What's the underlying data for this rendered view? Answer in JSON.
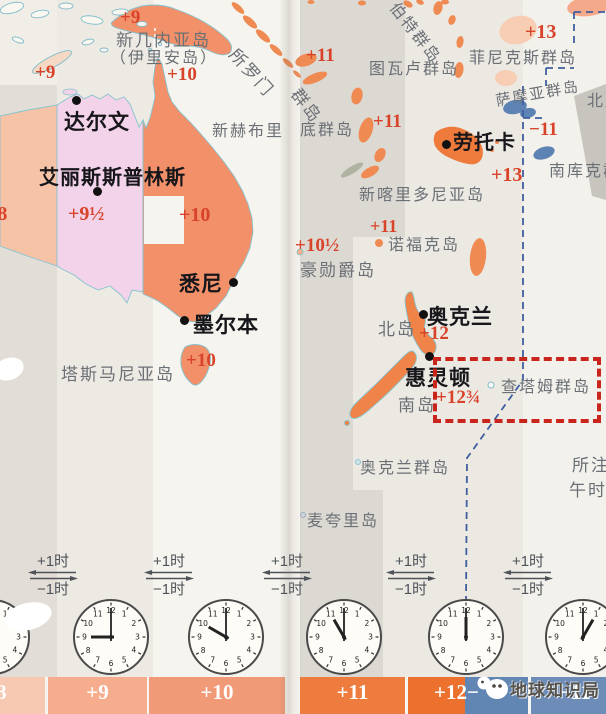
{
  "document": {
    "description": "扫描书页：大洋洲时区地图（澳大利亚/新西兰/太平洋岛屿）",
    "watermark_text": "地球知识局",
    "watermark_icon": "penguin-logo"
  },
  "colors": {
    "orange_land": "#f2906a",
    "strong_orange": "#ee7b3c",
    "pink_zone": "#f3d3e9",
    "salmon_zone": "#f7c3a6",
    "pale_island": "#f7cdb4",
    "blue_island": "#5d83b4",
    "red_label": "#d8432a",
    "gray_label": "#6b7076",
    "date_line_blue": "#3f5fa0",
    "annotation_red": "#c9251c",
    "bar_blue": "#6d8cb7"
  },
  "map_labels": [
    {
      "name": "tz-plus9-top",
      "text": "+9",
      "x": 120,
      "y": 7,
      "cls": "lbl-zone",
      "size": 19
    },
    {
      "name": "tz-plus9-west",
      "text": "+9",
      "x": 35,
      "y": 62,
      "cls": "lbl-zone",
      "size": 19
    },
    {
      "name": "tz-plus10-north",
      "text": "+10",
      "x": 167,
      "y": 64,
      "cls": "lbl-zone",
      "size": 19
    },
    {
      "name": "tz-plus8-west",
      "text": "+8",
      "x": -14,
      "y": 203,
      "cls": "lbl-zone",
      "size": 20
    },
    {
      "name": "tz-plus9half",
      "text": "+9½",
      "x": 68,
      "y": 203,
      "cls": "lbl-zone",
      "size": 20
    },
    {
      "name": "tz-plus10-mid",
      "text": "+10",
      "x": 179,
      "y": 204,
      "cls": "lbl-zone",
      "size": 20
    },
    {
      "name": "tz-plus10-tasmania",
      "text": "+10",
      "x": 186,
      "y": 350,
      "cls": "lbl-zone",
      "size": 19
    },
    {
      "name": "tz-plus11-santacruz",
      "text": "+11",
      "x": 306,
      "y": 45,
      "cls": "lbl-zone",
      "size": 19
    },
    {
      "name": "tz-plus11-vanuatu",
      "text": "+11",
      "x": 373,
      "y": 111,
      "cls": "lbl-zone",
      "size": 19
    },
    {
      "name": "tz-plus11-norfolk",
      "text": "+11",
      "x": 370,
      "y": 216,
      "cls": "lbl-zone",
      "size": 18
    },
    {
      "name": "tz-plus10half",
      "text": "+10½",
      "x": 295,
      "y": 235,
      "cls": "lbl-zone",
      "size": 19
    },
    {
      "name": "tz-plus12-nz",
      "text": "+12",
      "x": 419,
      "y": 323,
      "cls": "lbl-zone",
      "size": 19
    },
    {
      "name": "tz-plus12-threequarters",
      "text": "+12¾",
      "x": 436,
      "y": 387,
      "cls": "lbl-zone",
      "size": 19
    },
    {
      "name": "tz-plus13-phoenix",
      "text": "+13",
      "x": 525,
      "y": 21,
      "cls": "lbl-zone",
      "size": 20
    },
    {
      "name": "tz-plus13-fiji-east",
      "text": "+13",
      "x": 491,
      "y": 164,
      "cls": "lbl-zone",
      "size": 20
    },
    {
      "name": "tz-minus11",
      "text": "−11",
      "x": 529,
      "y": 119,
      "cls": "lbl-zone",
      "size": 19
    },
    {
      "name": "label-new-guinea-line1",
      "text": "新几内亚岛",
      "x": 116,
      "y": 26,
      "cls": "lbl-geo",
      "size": 17
    },
    {
      "name": "label-new-guinea-line2",
      "text": "（伊里安岛）",
      "x": 110,
      "y": 44,
      "cls": "lbl-geo",
      "size": 16
    },
    {
      "name": "label-solomon-part1",
      "text": "所罗门",
      "x": 243,
      "y": 42,
      "cls": "lbl-geo",
      "size": 17,
      "rot": 48
    },
    {
      "name": "label-solomon-part2",
      "text": "群岛",
      "x": 306,
      "y": 82,
      "cls": "lbl-geo",
      "size": 17,
      "rot": 52
    },
    {
      "name": "label-new-hebrides-part1",
      "text": "新赫布里",
      "x": 212,
      "y": 117,
      "cls": "lbl-geo",
      "size": 16
    },
    {
      "name": "label-new-hebrides-part2",
      "text": "底群岛",
      "x": 300,
      "y": 116,
      "cls": "lbl-geo",
      "size": 16
    },
    {
      "name": "label-tuvalu",
      "text": "图瓦卢群岛",
      "x": 369,
      "y": 55,
      "cls": "lbl-geo",
      "size": 16
    },
    {
      "name": "label-gilbert-partial",
      "text": "伯特群岛",
      "x": 404,
      "y": -4,
      "cls": "lbl-geo",
      "size": 16,
      "rot": 52
    },
    {
      "name": "label-phoenix-islands",
      "text": "菲尼克斯群岛",
      "x": 469,
      "y": 44,
      "cls": "lbl-geo",
      "size": 16
    },
    {
      "name": "label-samoa",
      "text": "萨摩亚群岛",
      "x": 494,
      "y": 90,
      "cls": "lbl-geo",
      "size": 15,
      "rot": -10
    },
    {
      "name": "label-north-cook-partial",
      "text": "北库克群岛",
      "x": 587,
      "y": 87,
      "cls": "lbl-geo",
      "size": 16
    },
    {
      "name": "label-south-cook-partial",
      "text": "南库克群岛",
      "x": 549,
      "y": 157,
      "cls": "lbl-geo",
      "size": 16
    },
    {
      "name": "label-new-caledonia",
      "text": "新喀里多尼亚岛",
      "x": 359,
      "y": 181,
      "cls": "lbl-geo",
      "size": 16
    },
    {
      "name": "label-norfolk-island",
      "text": "诺福克岛",
      "x": 388,
      "y": 231,
      "cls": "lbl-geo",
      "size": 16
    },
    {
      "name": "label-lord-howe",
      "text": "豪勋爵岛",
      "x": 300,
      "y": 256,
      "cls": "lbl-geo",
      "size": 17
    },
    {
      "name": "label-north-island",
      "text": "北岛",
      "x": 378,
      "y": 315,
      "cls": "lbl-geo",
      "size": 17
    },
    {
      "name": "label-south-island",
      "text": "南岛",
      "x": 398,
      "y": 391,
      "cls": "lbl-geo",
      "size": 17
    },
    {
      "name": "label-chatham-islands",
      "text": "查塔姆群岛",
      "x": 501,
      "y": 373,
      "cls": "lbl-geo",
      "size": 16
    },
    {
      "name": "label-auckland-islands",
      "text": "奥克兰群岛",
      "x": 360,
      "y": 454,
      "cls": "lbl-geo",
      "size": 16
    },
    {
      "name": "label-macquarie-island",
      "text": "麦夸里岛",
      "x": 307,
      "y": 507,
      "cls": "lbl-geo",
      "size": 16
    },
    {
      "name": "label-tasmania",
      "text": "塔斯马尼亚岛",
      "x": 61,
      "y": 360,
      "cls": "lbl-geo",
      "size": 17
    },
    {
      "name": "label-note-line1",
      "text": "所注",
      "x": 572,
      "y": 451,
      "cls": "lbl-geo",
      "size": 17
    },
    {
      "name": "label-note-line2",
      "text": "午时",
      "x": 569,
      "y": 476,
      "cls": "lbl-geo",
      "size": 17
    }
  ],
  "cities": [
    {
      "name": "city-darwin",
      "text": "达尔文",
      "x": 64,
      "y": 106,
      "size": 21,
      "dot": {
        "x": 76,
        "y": 100
      }
    },
    {
      "name": "city-alice-springs",
      "text": "艾丽斯斯普林斯",
      "x": 39,
      "y": 161,
      "size": 20,
      "dot": {
        "x": 97,
        "y": 191
      }
    },
    {
      "name": "city-sydney",
      "text": "悉尼",
      "x": 179,
      "y": 268,
      "size": 21,
      "dot": {
        "x": 233,
        "y": 282
      }
    },
    {
      "name": "city-melbourne",
      "text": "墨尔本",
      "x": 193,
      "y": 309,
      "size": 21,
      "dot": {
        "x": 184,
        "y": 320
      }
    },
    {
      "name": "city-lautoka",
      "text": "劳托卡",
      "x": 453,
      "y": 126,
      "size": 20,
      "dot": {
        "x": 446,
        "y": 144
      }
    },
    {
      "name": "city-auckland",
      "text": "奥克兰",
      "x": 427,
      "y": 301,
      "size": 21,
      "dot": {
        "x": 423,
        "y": 314
      }
    },
    {
      "name": "city-wellington",
      "text": "惠灵顿",
      "x": 405,
      "y": 362,
      "size": 21,
      "dot": {
        "x": 429,
        "y": 356
      }
    }
  ],
  "annotation": {
    "highlighted_place": "查塔姆群岛"
  },
  "exchange": {
    "plus": "+1时",
    "minus": "−1时",
    "positions": [
      53,
      169,
      287,
      411,
      528
    ]
  },
  "clocks": {
    "cy": 637,
    "r": 37,
    "numerals": [
      "12",
      "1",
      "2",
      "3",
      "4",
      "5",
      "6",
      "7",
      "8",
      "9",
      "10",
      "11"
    ],
    "items": [
      {
        "name": "clock-plus8",
        "time": "8:00",
        "hour_angle": 240,
        "cx": -8
      },
      {
        "name": "clock-plus9",
        "time": "9:00",
        "hour_angle": 270,
        "cx": 111
      },
      {
        "name": "clock-plus10",
        "time": "10:00",
        "hour_angle": 300,
        "cx": 226
      },
      {
        "name": "clock-plus11",
        "time": "11:00",
        "hour_angle": 330,
        "cx": 344
      },
      {
        "name": "clock-plus12",
        "time": "12:00",
        "hour_angle": 0,
        "cx": 466
      },
      {
        "name": "clock-minus11",
        "time": "1:00",
        "hour_angle": 30,
        "cx": 583
      }
    ]
  },
  "timezone_strip": {
    "segments": [
      {
        "name": "bar-plus8",
        "label": "+8",
        "x": 0,
        "w": 45,
        "color": "#f8c9b2",
        "lx": -16
      },
      {
        "name": "bar-plus9",
        "label": "+9",
        "x": 48,
        "w": 99,
        "color": "#f5ad8e"
      },
      {
        "name": "bar-plus10",
        "label": "+10",
        "x": 149,
        "w": 136,
        "color": "#f19a77"
      },
      {
        "name": "bar-plus11",
        "label": "+11",
        "x": 300,
        "w": 105,
        "color": "#ee7c3e"
      },
      {
        "name": "bar-plus12-dateline",
        "label": "+12−",
        "x": 408,
        "w": 120,
        "color": "#ec702e",
        "color2": "#6286b4",
        "split": 57,
        "lx": 26
      },
      {
        "name": "bar-minus11",
        "label": "−11",
        "x": 531,
        "w": 75,
        "color": "#6d8cb7",
        "lx": 28
      }
    ]
  }
}
